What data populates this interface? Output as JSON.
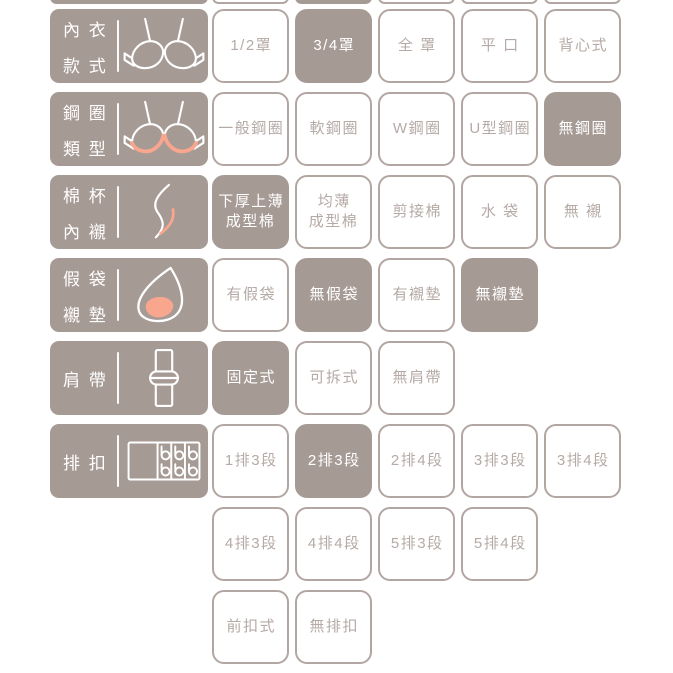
{
  "palette": {
    "mauve": "#a69a95",
    "button_border": "#b2a6a2",
    "muted_text": "#b5aaa6",
    "selected_text": "#ffffff",
    "accent_pink": "#f9a68f",
    "background": "#ffffff"
  },
  "board": {
    "cutoff_row": {
      "label_selected": true,
      "options_selected": [
        false,
        true,
        false,
        false,
        false
      ]
    },
    "lines": [
      {
        "label": {
          "lines": [
            "內 衣",
            "款 式"
          ],
          "icon": "bra-icon"
        },
        "options": [
          {
            "label": "1/2罩",
            "selected": false
          },
          {
            "label": "3/4罩",
            "selected": true
          },
          {
            "label": "全 罩",
            "selected": false
          },
          {
            "label": "平 口",
            "selected": false
          },
          {
            "label": "背心式",
            "selected": false
          }
        ]
      },
      {
        "label": {
          "lines": [
            "鋼 圈",
            "類 型"
          ],
          "icon": "bra-underwire-icon"
        },
        "options": [
          {
            "label": "一般鋼圈",
            "selected": false
          },
          {
            "label": "軟鋼圈",
            "selected": false
          },
          {
            "label": "W鋼圈",
            "selected": false
          },
          {
            "label": "U型鋼圈",
            "selected": false
          },
          {
            "label": "無鋼圈",
            "selected": true
          }
        ]
      },
      {
        "label": {
          "lines": [
            "棉 杯",
            "內 襯"
          ],
          "icon": "cup-profile-icon"
        },
        "options": [
          {
            "label": "下厚上薄\n成型棉",
            "selected": true
          },
          {
            "label": "均薄\n成型棉",
            "selected": false
          },
          {
            "label": "剪接棉",
            "selected": false
          },
          {
            "label": "水 袋",
            "selected": false
          },
          {
            "label": "無 襯",
            "selected": false
          }
        ]
      },
      {
        "label": {
          "lines": [
            "假 袋",
            "襯 墊"
          ],
          "icon": "pad-icon"
        },
        "options": [
          {
            "label": "有假袋",
            "selected": false
          },
          {
            "label": "無假袋",
            "selected": true
          },
          {
            "label": "有襯墊",
            "selected": false
          },
          {
            "label": "無襯墊",
            "selected": true
          }
        ]
      },
      {
        "label": {
          "lines": [
            "肩 帶"
          ],
          "icon": "shoulder-strap-icon"
        },
        "options": [
          {
            "label": "固定式",
            "selected": true
          },
          {
            "label": "可拆式",
            "selected": false
          },
          {
            "label": "無肩帶",
            "selected": false
          }
        ]
      },
      {
        "label": {
          "lines": [
            "排 扣"
          ],
          "icon": "hook-closure-icon"
        },
        "options": [
          {
            "label": "1排3段",
            "selected": false
          },
          {
            "label": "2排3段",
            "selected": true
          },
          {
            "label": "2排4段",
            "selected": false
          },
          {
            "label": "3排3段",
            "selected": false
          },
          {
            "label": "3排4段",
            "selected": false
          }
        ]
      },
      {
        "label": null,
        "options": [
          {
            "label": "4排3段",
            "selected": false
          },
          {
            "label": "4排4段",
            "selected": false
          },
          {
            "label": "5排3段",
            "selected": false
          },
          {
            "label": "5排4段",
            "selected": false
          }
        ]
      },
      {
        "label": null,
        "options": [
          {
            "label": "前扣式",
            "selected": false
          },
          {
            "label": "無排扣",
            "selected": false
          }
        ]
      }
    ]
  }
}
